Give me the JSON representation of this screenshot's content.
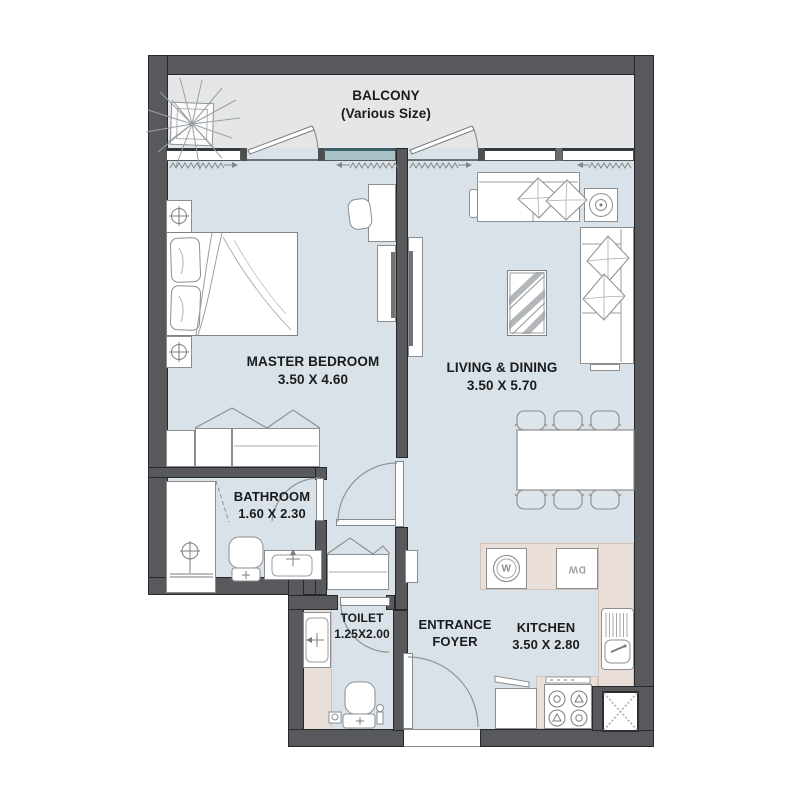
{
  "plan": {
    "balcony": {
      "label": "BALCONY",
      "sublabel": "(Various Size)"
    },
    "master_bedroom": {
      "label": "MASTER BEDROOM",
      "dimensions": "3.50 X 4.60"
    },
    "living_dining": {
      "label": "LIVING & DINING",
      "dimensions": "3.50 X 5.70"
    },
    "bathroom": {
      "label": "BATHROOM",
      "dimensions": "1.60 X 2.30"
    },
    "toilet": {
      "label": "TOILET",
      "dimensions": "1.25X2.00"
    },
    "entrance_foyer": {
      "label_line1": "ENTRANCE",
      "label_line2": "FOYER"
    },
    "kitchen": {
      "label": "KITCHEN",
      "dimensions": "3.50 X 2.80"
    },
    "appliances": {
      "washing_machine": "W",
      "dishwasher": "DW"
    }
  },
  "colors": {
    "wall": "#57595c",
    "floor": "#d9e2e9",
    "balcony": "#e5e6e7",
    "counter": "#eadfd8",
    "glass": "#aac1c8",
    "text": "#1b1b1b"
  }
}
